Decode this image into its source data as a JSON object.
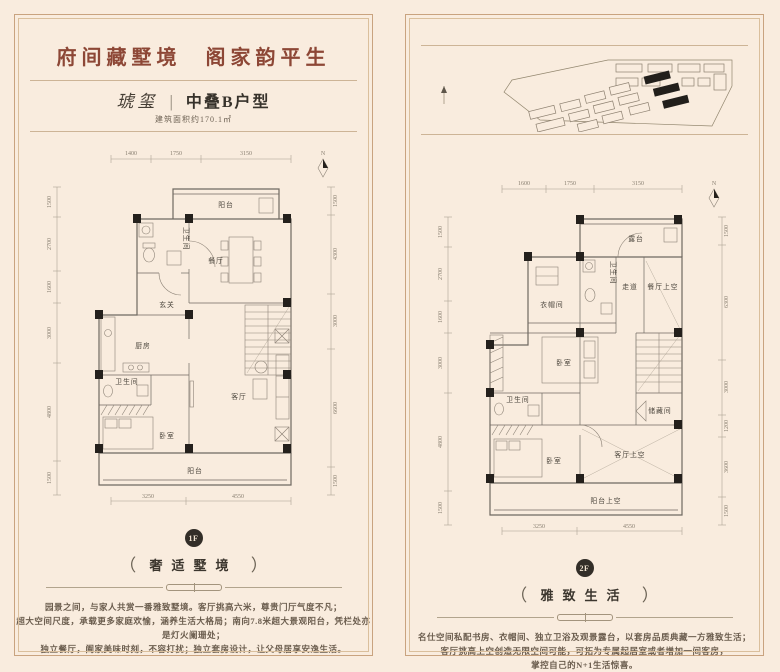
{
  "page": {
    "bg": "#f9ecde",
    "accent": "#8d4736"
  },
  "left_panel": {
    "header": {
      "title_1": "府间藏墅境",
      "title_2": "阁家韵平生",
      "brand": "琥玺",
      "separator": "|",
      "type_name": "中叠B户型",
      "area": "建筑面积约170.1㎡"
    },
    "plan": {
      "north": "N",
      "dims_top": [
        "1400",
        "1750",
        "3150"
      ],
      "dims_left": [
        "1500",
        "2700",
        "1600",
        "3000",
        "4800",
        "1500"
      ],
      "dims_right": [
        "1500",
        "4300",
        "3000",
        "6600",
        "1500"
      ],
      "dims_bottom": [
        "3250",
        "4550"
      ],
      "rooms": {
        "balcony_top": "阳台",
        "bath_top": "卫生间",
        "dining": "餐厅",
        "foyer": "玄关",
        "kitchen": "厨房",
        "bath_low": "卫生间",
        "bedroom": "卧室",
        "living": "客厅",
        "balcony_low": "阳台"
      }
    },
    "footer": {
      "badge": "1F",
      "paren_open": "（",
      "paren_close": "）",
      "label": "奢适墅境",
      "lines": [
        "园景之间，与家人共赏一番雅致墅境。客厅挑高六米，尊贵门厅气度不凡；",
        "超大空间尺度，承载更多家庭欢愉，涵养生活大格局；南向7.8米超大景观阳台，凭栏处亦是灯火阑珊处；",
        "独立餐厅，阖家美味时刻，不容打扰；独立套房设计，让父母居享安逸生活。"
      ]
    }
  },
  "right_panel": {
    "plan": {
      "north": "N",
      "dims_top": [
        "1600",
        "1750",
        "3150"
      ],
      "dims_left": [
        "1500",
        "2700",
        "1600",
        "3000",
        "4800",
        "1500"
      ],
      "dims_right": [
        "1500",
        "6300",
        "3000",
        "1200",
        "3600",
        "1500"
      ],
      "dims_bottom": [
        "3250",
        "4550"
      ],
      "rooms": {
        "terrace": "露台",
        "cloakroom": "衣帽间",
        "bath_top": "卫生间",
        "corridor": "走道",
        "dining_void": "餐厅上空",
        "bedroom_master": "卧室",
        "storage": "储藏间",
        "bath_low": "卫生间",
        "bedroom_low": "卧室",
        "living_void": "客厅上空",
        "balcony_void": "阳台上空"
      }
    },
    "footer": {
      "badge": "2F",
      "paren_open": "（",
      "paren_close": "）",
      "label": "雅致生活",
      "lines": [
        "名仕空间私配书房、衣帽间、独立卫浴及观景露台，以套房品质典藏一方雅致生活；",
        "客厅挑高上空创造无限空间可能，可拓为专属起居室或者增加一间客房，",
        "掌控自己的N+1生活惊喜。"
      ]
    }
  }
}
